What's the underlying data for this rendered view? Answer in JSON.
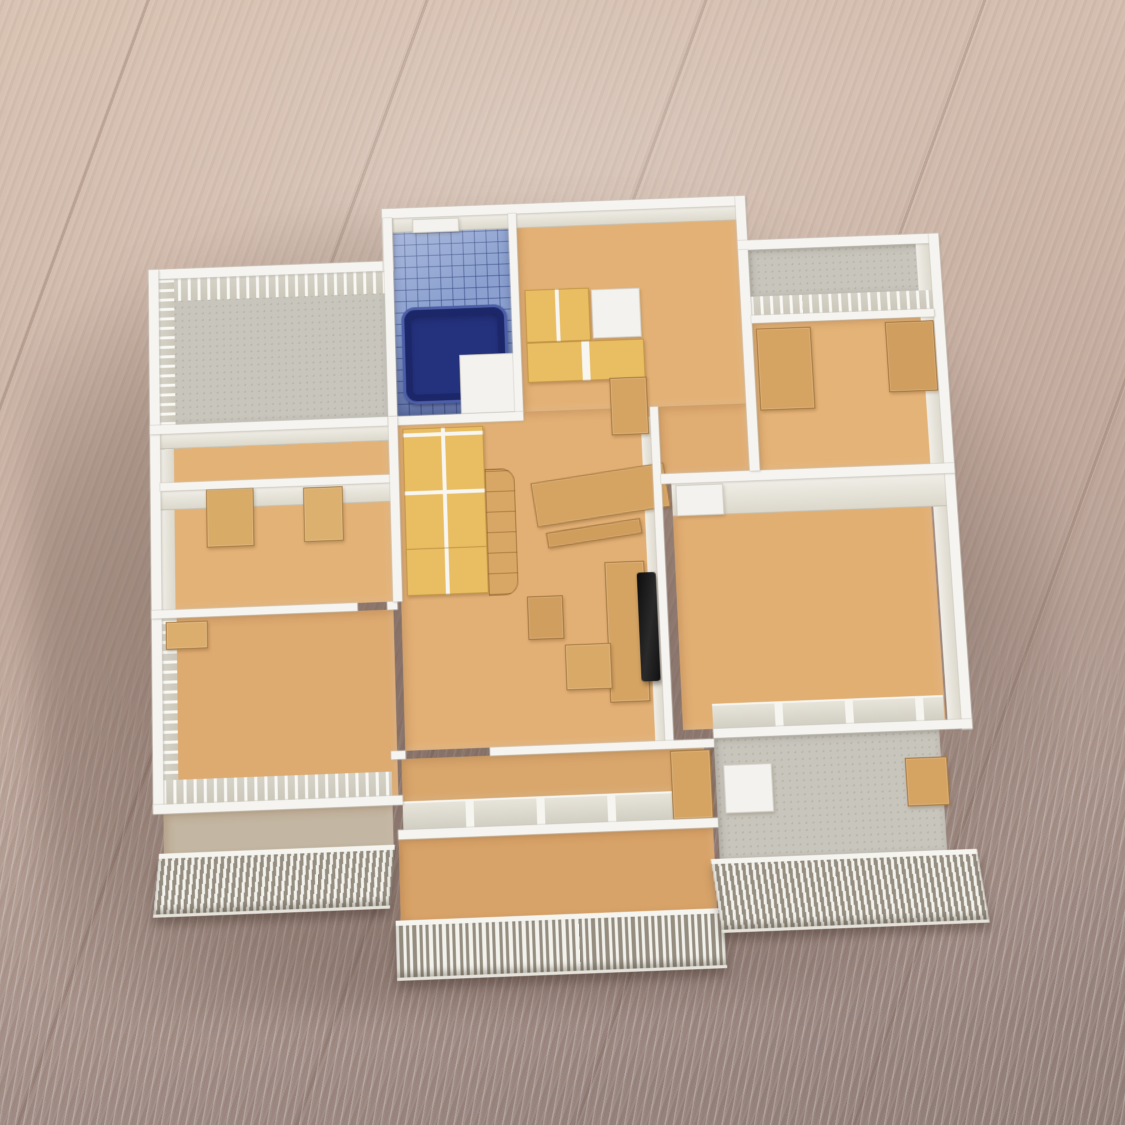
{
  "scene": {
    "type": "photograph",
    "subject": "hand-built architectural scale model of an apartment floor plan standing on a wooden table",
    "view": "overhead oblique, no ceiling, interiors visible",
    "description": "White foam-board architectural scale model of an apartment floor plan photographed from above on a light wooden table. Cardboard-tan floors and furniture, a blue tiled bathroom with a navy bathtub, yellow cabinet and wardrobe doors, a black TV panel in the living room, mullioned window walls, and white slatted balcony railings along the bottom edge."
  },
  "palette": {
    "wood_light": "#d9c3b3",
    "wood_dark": "#907d78",
    "wall_white": "#f5f4f0",
    "wall_face_cream": "#e9e6dc",
    "floor_cardboard_tan": "#e0ad72",
    "balcony_gray": "#c8c5bc",
    "tile_blue": "#8ba0cf",
    "bathtub_navy": "#24317d",
    "cabinet_yellow": "#e9bd62",
    "cardboard": "#d5a463",
    "tv_black": "#151515"
  },
  "model": {
    "rooms": [
      {
        "id": "sunroom-top-left",
        "floor": "gray speckled",
        "features": [
          "mullioned window walls north and west"
        ]
      },
      {
        "id": "bathroom",
        "floor": "blue tile",
        "features": [
          "navy bathtub",
          "white vanity block",
          "small north window"
        ]
      },
      {
        "id": "kitchen-entry",
        "floor": "cardboard tan",
        "features": [
          "yellow upper cabinets",
          "white appliance",
          "yellow counter with L-return"
        ]
      },
      {
        "id": "corridor-room-left",
        "floor": "cardboard tan",
        "features": [
          "cream closet wall",
          "large tan door panel",
          "small tan door"
        ]
      },
      {
        "id": "left-bedroom",
        "floor": "cardboard tan",
        "features": [
          "window wall south",
          "window wall west"
        ]
      },
      {
        "id": "living-room",
        "floor": "cardboard tan",
        "features": [
          "black TV on cardboard stand",
          "cardboard dining table and bench",
          "yellow wardrobe",
          "curved cardboard shelf column"
        ]
      },
      {
        "id": "top-right-bedroom",
        "floor": "cardboard tan",
        "features": [
          "north balcony strip with window wall",
          "cardboard wardrobe",
          "cardboard cabinet"
        ]
      },
      {
        "id": "right-bedroom",
        "floor": "cardboard tan",
        "features": [
          "white door leaf in north wall",
          "window wall south"
        ]
      },
      {
        "id": "center-bedroom",
        "floor": "cardboard tan",
        "features": [
          "window wall to balcony"
        ]
      }
    ],
    "balconies": [
      {
        "id": "balcony-left",
        "floor": "gray-tan",
        "railing": "white vertical slats"
      },
      {
        "id": "balcony-center",
        "floor": "cardboard tan",
        "railing": "white vertical slats",
        "note": "protrudes furthest toward viewer"
      },
      {
        "id": "balcony-right",
        "floor": "gray speckled",
        "railing": "white vertical slats",
        "features": [
          "cardboard side wall",
          "white cabinet box"
        ]
      }
    ],
    "furniture_counts": {
      "yellow_door_units": 4,
      "cardboard_pieces": 9,
      "tv": 1,
      "bathtub": 1
    }
  }
}
